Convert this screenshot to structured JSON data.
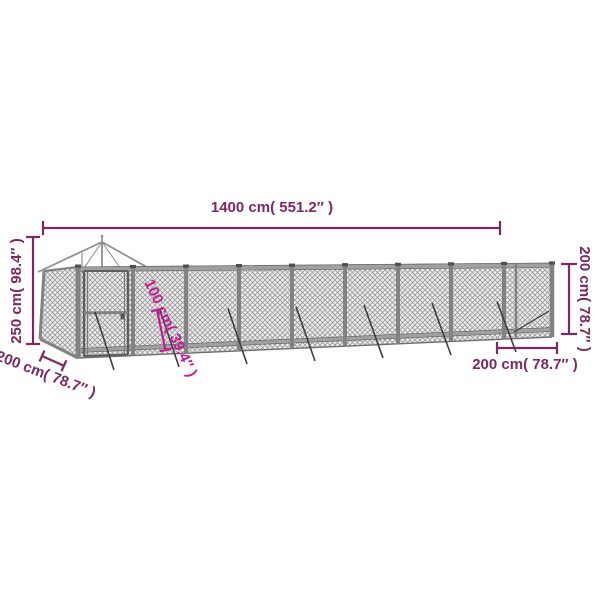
{
  "diagram": {
    "type": "product-dimension-diagram",
    "subject": "long-outdoor-kennel-with-roofed-section",
    "labels": {
      "top_length": "1400 cm( 551.2″ )",
      "left_height": "250 cm( 98.4″ )",
      "right_height": "200 cm( 78.7″ )",
      "bottom_left_depth": "200 cm( 78.7″ )",
      "bottom_right_depth": "200 cm( 78.7″ )",
      "inner_highlight": "100 cm( 39.4″ )"
    },
    "colors": {
      "dimension": "#7c2862",
      "highlight": "#c01d93",
      "mesh_line": "#9a9a9a",
      "frame_gray": "#828282",
      "background": "#ffffff"
    }
  }
}
